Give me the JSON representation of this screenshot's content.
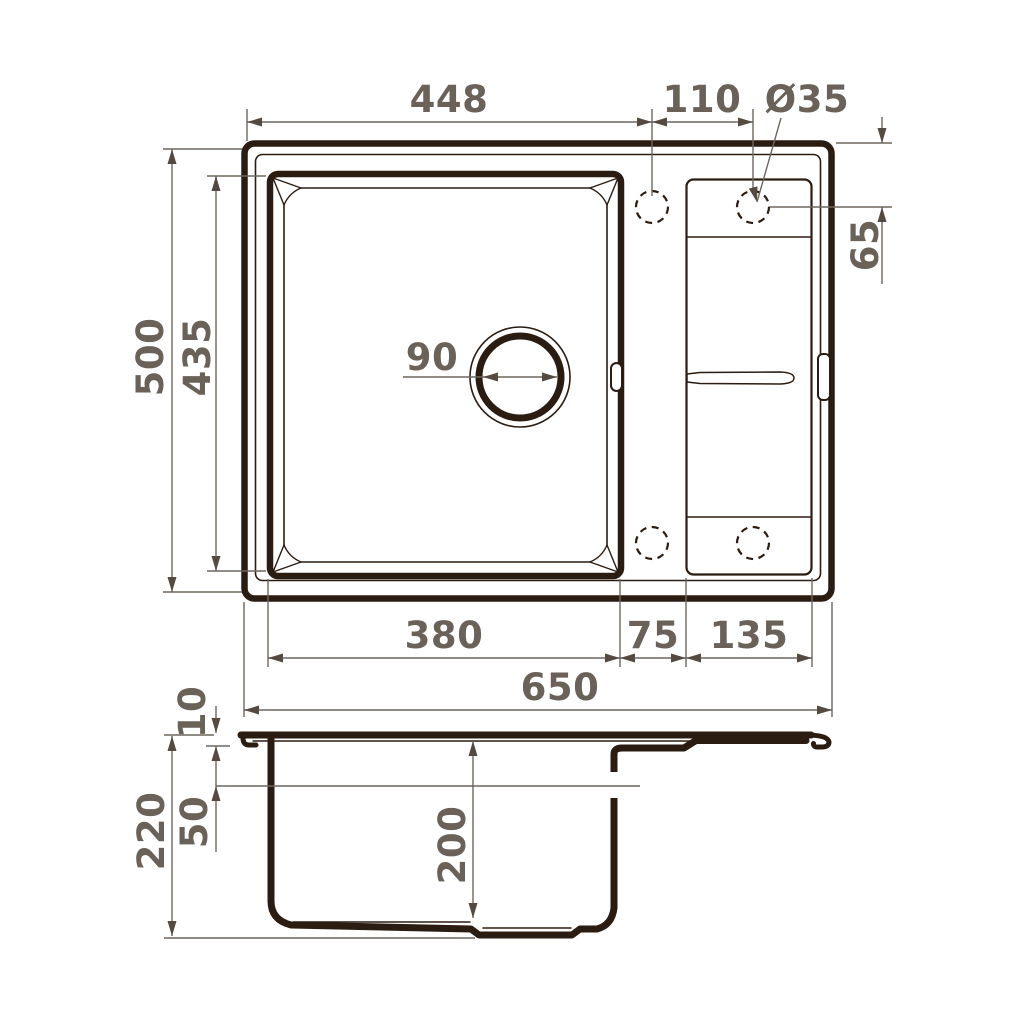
{
  "drawing": {
    "title": "sink-dimension-drawing",
    "colors": {
      "ink": "#2b1c11",
      "dim_line": "#6e665e",
      "dim_text": "#6a6159",
      "background": "#ffffff"
    },
    "top_view": {
      "dims": {
        "edge_to_tap": "448",
        "tap_spacing": "110",
        "tap_hole_diameter": "Ø35",
        "overall_depth": "500",
        "bowl_depth": "435",
        "tap_offset": "65",
        "drain_diameter": "90",
        "bowl_width": "380",
        "divider_width": "75",
        "wing_width": "135",
        "overall_width": "650"
      }
    },
    "side_view": {
      "dims": {
        "rim_thickness": "10",
        "ledge_depth": "50",
        "total_height": "220",
        "bowl_inner_depth": "200"
      }
    }
  }
}
